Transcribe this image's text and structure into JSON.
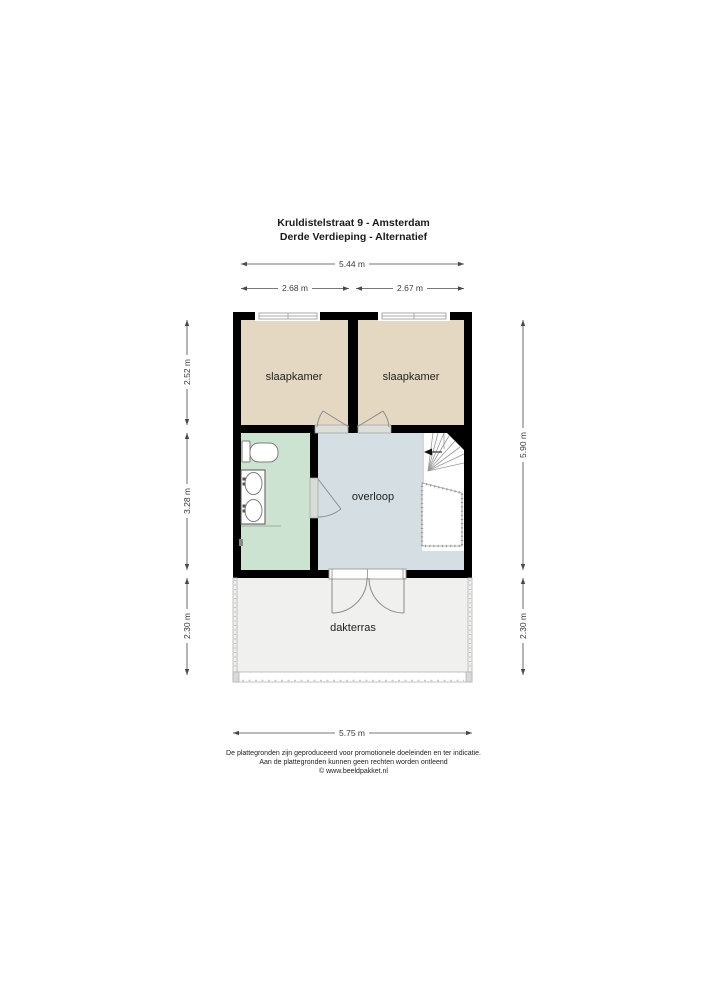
{
  "title": {
    "line1": "Kruldistelstraat 9 - Amsterdam",
    "line2": "Derde Verdieping - Alternatief"
  },
  "rooms": {
    "bedroom_left": "slaapkamer",
    "bedroom_right": "slaapkamer",
    "landing": "overloop",
    "terrace": "dakterras"
  },
  "dimensions": {
    "top_total": "5.44 m",
    "top_left": "2.68 m",
    "top_right": "2.67 m",
    "left_upper": "2.52 m",
    "left_middle": "3.28 m",
    "left_lower": "2.30 m",
    "right_main": "5.90 m",
    "right_lower": "2.30 m",
    "bottom_total": "5.75 m"
  },
  "footer": {
    "line1": "De plattegronden zijn geproduceerd voor promotionele doeleinden en ter indicatie.",
    "line2": "Aan de plattegronden kunnen geen rechten worden ontleend",
    "line3": "© www.beeldpakket.nl"
  },
  "colors": {
    "wall": "#000000",
    "bedroom": "#e4d8c2",
    "bathroom": "#cde3d1",
    "landing": "#d5dfe3",
    "terrace": "#f0f0ee"
  }
}
